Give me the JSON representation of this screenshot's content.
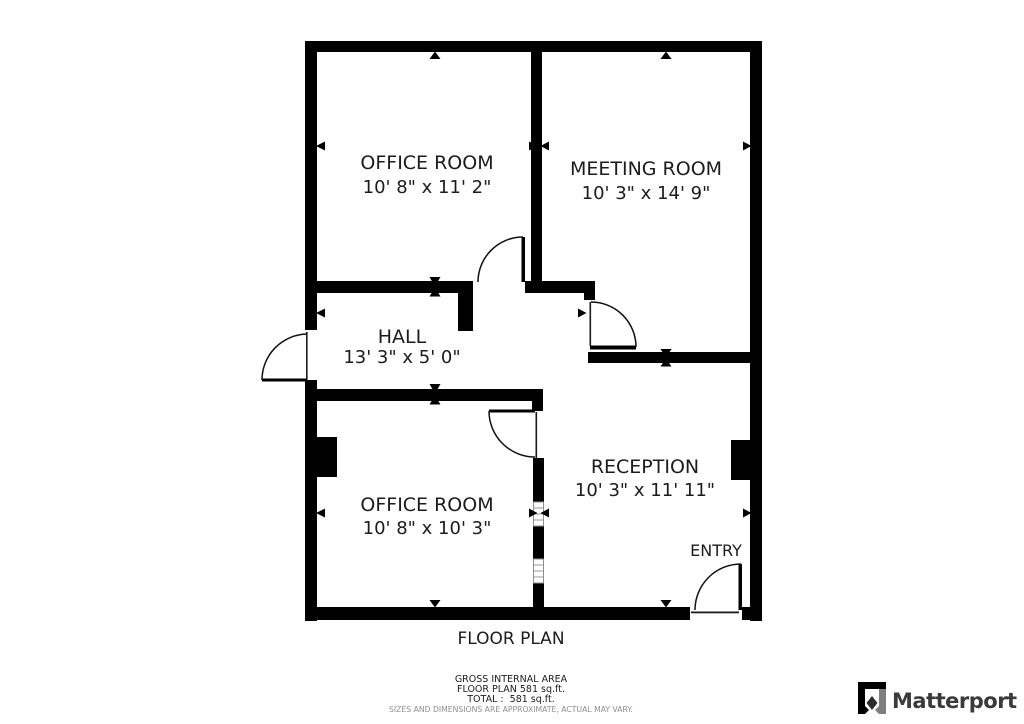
{
  "plan": {
    "title": "FLOOR PLAN",
    "rooms": [
      {
        "name": "OFFICE ROOM",
        "dims": "10' 8\" x 11' 2\""
      },
      {
        "name": "MEETING ROOM",
        "dims": "10' 3\" x 14' 9\""
      },
      {
        "name": "HALL",
        "dims": "13' 3\" x 5' 0\""
      },
      {
        "name": "OFFICE ROOM",
        "dims": "10' 8\" x 10' 3\""
      },
      {
        "name": "RECEPTION",
        "dims": "10' 3\" x 11' 11\""
      }
    ],
    "entry_label": "ENTRY"
  },
  "footer": {
    "area_title": "GROSS INTERNAL AREA",
    "floor_plan_area": "FLOOR PLAN 581 sq.ft.",
    "total_area": "TOTAL :  581 sq.ft.",
    "disclaimer": "SIZES AND DIMENSIONS ARE APPROXIMATE, ACTUAL MAY VARY."
  },
  "branding": {
    "wordmark": "Matterport"
  },
  "colors": {
    "wall": "#000000",
    "text": "#1c1c1c",
    "disclaimer_text": "#8f8f8f",
    "wordmark_text": "#3a3a3a",
    "logo_gray": "#7e7e7e"
  }
}
